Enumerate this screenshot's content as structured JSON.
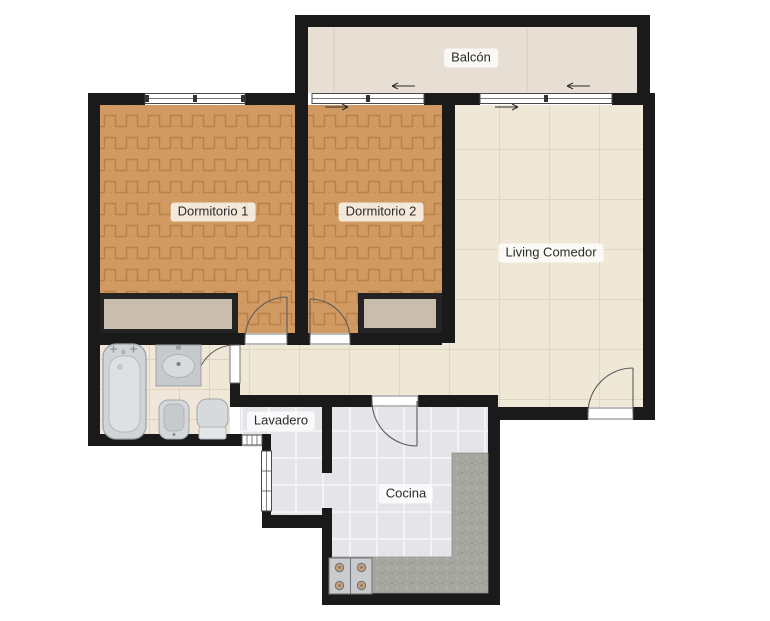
{
  "floor_plan": {
    "rooms": [
      {
        "name": "balcon",
        "label": "Balcón"
      },
      {
        "name": "dormitorio-1",
        "label": "Dormitorio 1"
      },
      {
        "name": "dormitorio-2",
        "label": "Dormitorio 2"
      },
      {
        "name": "living-comedor",
        "label": "Living Comedor"
      },
      {
        "name": "lavadero",
        "label": "Lavadero"
      },
      {
        "name": "cocina",
        "label": "Cocina"
      }
    ],
    "fixtures": [
      "bathtub",
      "sink",
      "bidet",
      "toilet",
      "stove",
      "counter",
      "closet-dormitorio-1",
      "closet-dormitorio-2"
    ],
    "openings": [
      "window-dormitorio-1",
      "sliding-door-dormitorio-2",
      "sliding-door-living",
      "door-dormitorio-1",
      "door-dormitorio-2",
      "door-bathroom",
      "door-cocina",
      "entry-door",
      "window-lavadero-small",
      "window-lavadero-tall"
    ],
    "colors": {
      "wall": "#1a1a1a",
      "parquet": "#d09a62",
      "parquet_line": "#bb8045",
      "living_floor": "#efe8d7",
      "balcony_floor": "#e7dfd3",
      "bathroom_floor": "#f1e7d8",
      "kitchen_floor": "#e4e4e9",
      "counter": "#a7a7a2",
      "closet": "#c9bdae",
      "fixture": "#d5d8da",
      "background": "#ffffff"
    }
  }
}
